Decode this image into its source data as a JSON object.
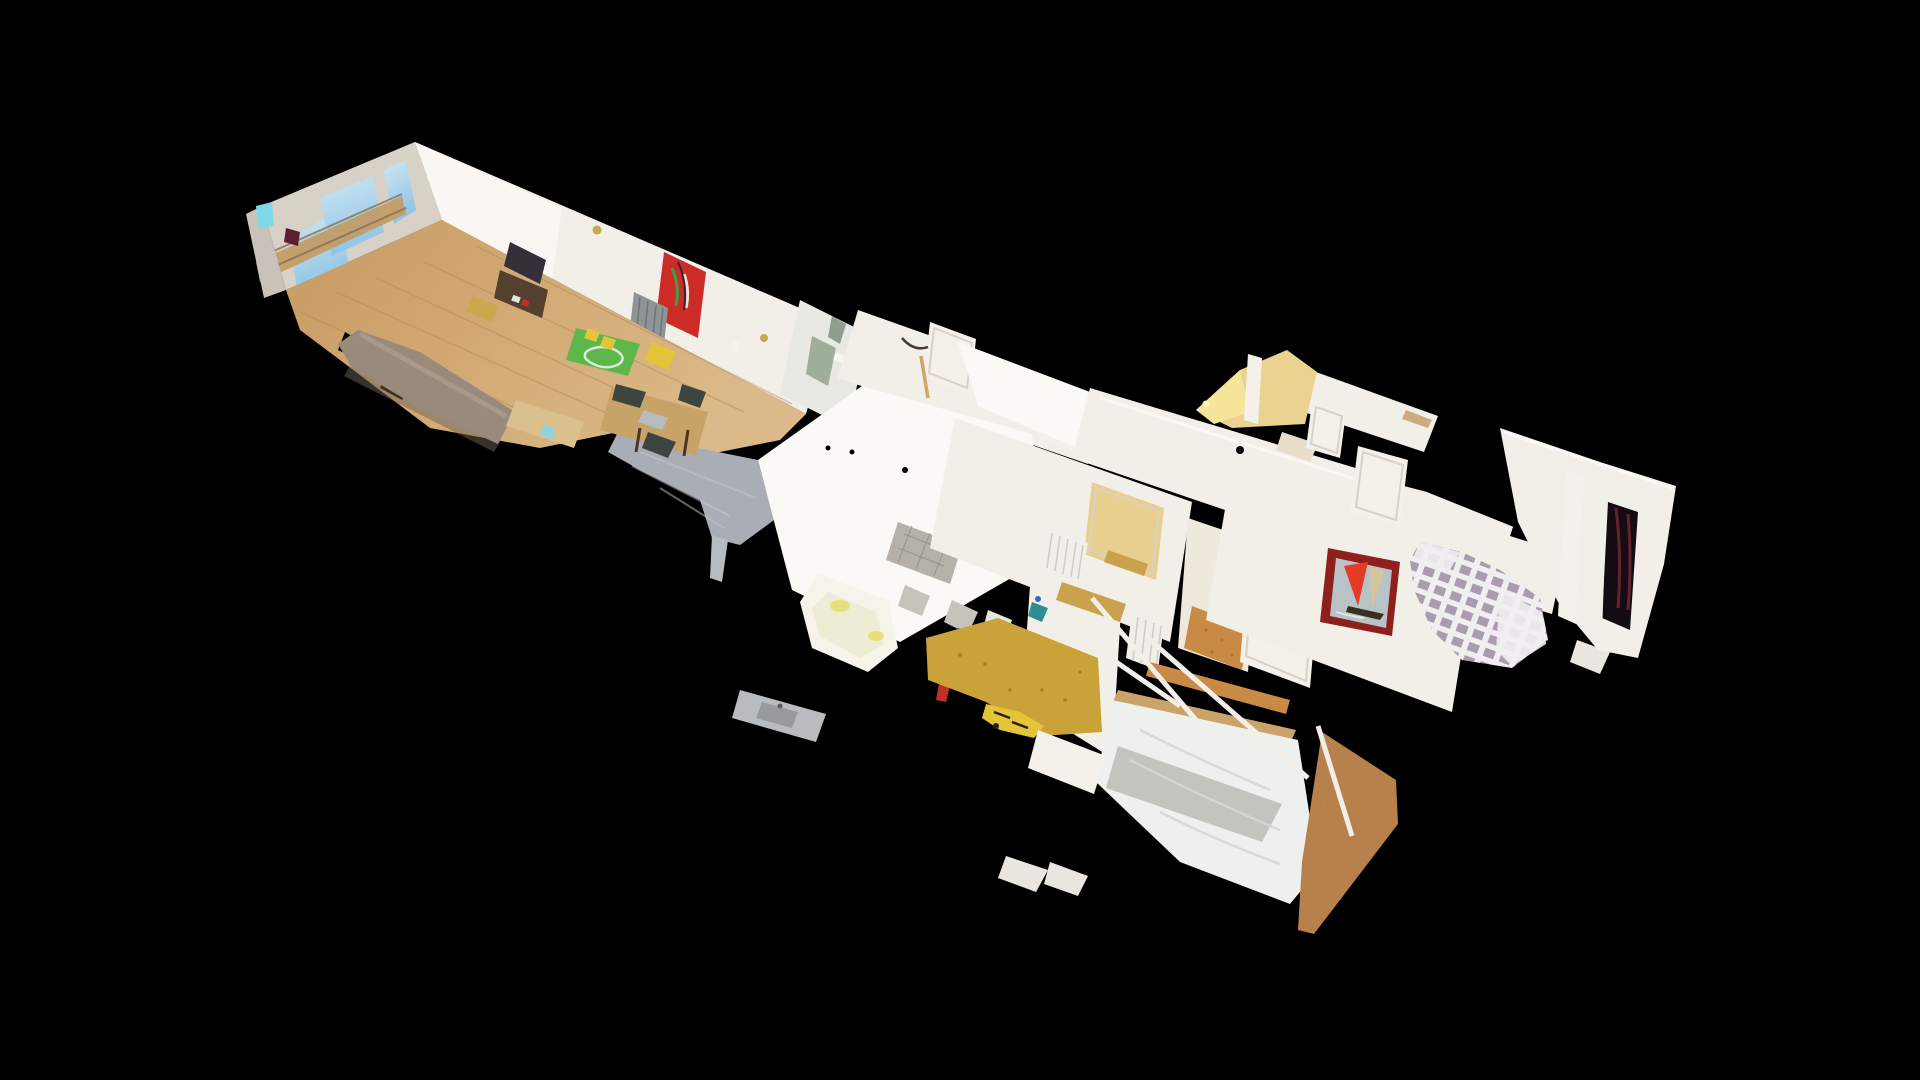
{
  "viewer": {
    "name": "3d-tour-dollhouse-view",
    "background": "#000000",
    "interaction": "drag-to-orbit"
  },
  "scene": {
    "description": "Textured photogrammetry dollhouse scan of an apartment, viewed from an elevated oblique angle, floating on a black void. Ragged scan-mesh edges and holes throughout.",
    "rooms": [
      {
        "name": "living-room",
        "features": [
          "balcony-window-wall-with-sky-view",
          "sofa",
          "tv-on-cabinet",
          "green-play-rug-with-toys",
          "red-abstract-painting",
          "radiator",
          "oak-wood-floor"
        ]
      },
      {
        "name": "dining-area",
        "features": [
          "wooden-table",
          "dark-chairs",
          "grey-shaded-floor"
        ]
      },
      {
        "name": "kitchen",
        "features": [
          "peeled-wall",
          "steel-counter-with-sink",
          "white-partition-walls"
        ]
      },
      {
        "name": "bathroom",
        "features": [
          "bathtub",
          "grey-tiled-floor"
        ]
      },
      {
        "name": "hallway",
        "features": [
          "white-doors",
          "ribbed-radiators",
          "orange-cork-floor",
          "warm-lit-nook",
          "coat-hook"
        ]
      },
      {
        "name": "bedroom-main",
        "features": [
          "white-duvet-double-bed",
          "wood-bed-rail",
          "walnut-floor-strip",
          "scattered-scan-debris",
          "yellow-toy"
        ]
      },
      {
        "name": "bedroom-second",
        "features": [
          "checkered-mauve-duvet-bed",
          "sailboat-painting-red-sail",
          "dark-window-opening",
          "white-curtain"
        ]
      }
    ]
  },
  "palette": {
    "background": "#000000",
    "wall_white": "#f2efe9",
    "wall_bright": "#fbf9f5",
    "wall_shadow": "#d7d1c8",
    "wall_cream": "#efe8dc",
    "ceiling_grey": "#cfc9c1",
    "wall_peel": "#e7e9e2",
    "peel_green": "#9fae9a",
    "sky_blue": "#8fc4e4",
    "sky_pale": "#cfe7f4",
    "balcony_tan": "#c29a62",
    "floor_oak": "#c89a62",
    "floor_oak_light": "#dcb988",
    "floor_grey": "#a9aeb6",
    "floor_orange": "#c98a45",
    "floor_ochre": "#c9a23a",
    "floor_walnut": "#b8804a",
    "rug_green": "#5cb84a",
    "couch_taupe": "#9a8a7c",
    "table_tan": "#c8a368",
    "bench_tan": "#d9c08c",
    "cabinet_brown": "#53402f",
    "tv_dark": "#33303a",
    "painting_red": "#cc2b26",
    "radiator_grey": "#8f9496",
    "radiator_white": "#f1efe9",
    "tub_white": "#f6f3ea",
    "tub_inner": "#efecd6",
    "glow_yellow": "#e6e07a",
    "tile_grey": "#b5b1a8",
    "counter_steel": "#b9bcbe",
    "sink_steel": "#989b9d",
    "bed_white": "#eef0ee",
    "pillow_white": "#f8f9f7",
    "blanket_sage": "#b8bdb4",
    "checker_base": "#f1eef2",
    "checker_mauve": "#a393a8",
    "frame_maroon": "#8e1f1c",
    "sea_grey": "#b7c3c6",
    "sail_red": "#e23b28",
    "sail_tan": "#d9c49a",
    "hull_dark": "#3a2e22",
    "window_dark": "#140c12",
    "curtain_white": "#f3f1ec",
    "door_white": "#f4f1ea",
    "wood_rail": "#caa36b",
    "glow_warm": "#e8cf8e",
    "nook_yellow": "#ead391",
    "nook_bright": "#f6e49a",
    "accent_cyan": "#7fd8e8",
    "accent_maroon": "#5a2030",
    "accent_gold": "#c9a84e",
    "accent_yellow": "#e4c53a",
    "accent_red": "#c03028",
    "accent_teal": "#2f8c94",
    "accent_navy": "#2a3340",
    "accent_blue": "#2a6ad0",
    "gold_band": "#caa14c"
  }
}
